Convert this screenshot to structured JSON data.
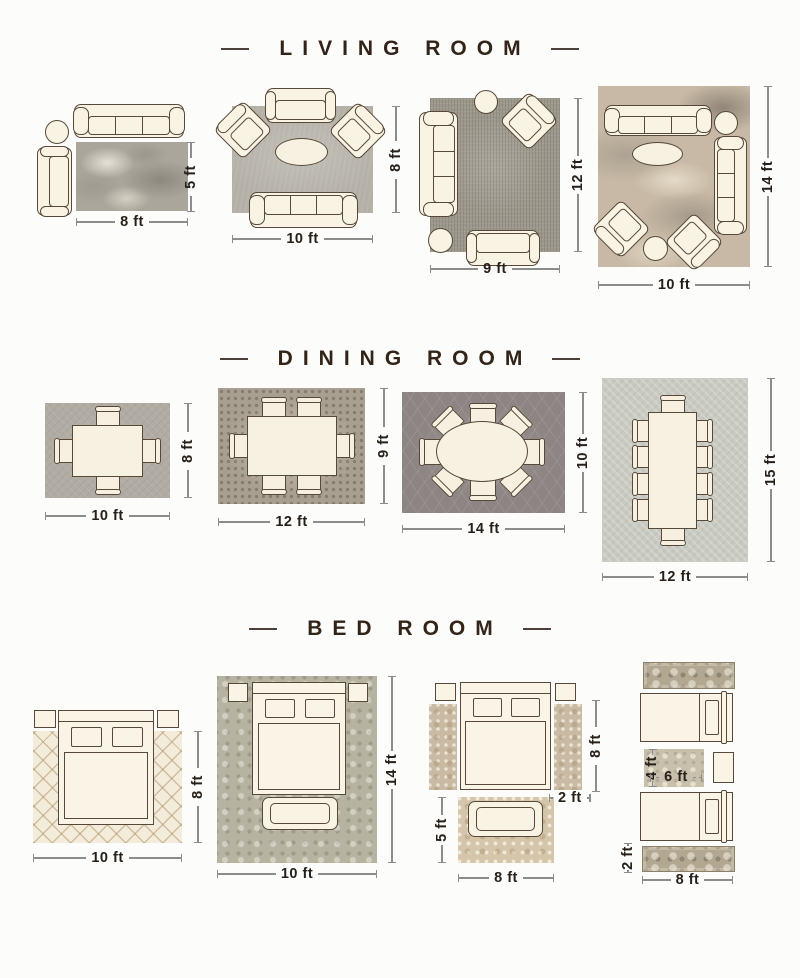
{
  "sections": [
    {
      "title": "LIVING ROOM",
      "layouts": [
        {
          "id": "living-1",
          "bottom": "8 ft",
          "side": "5 ft"
        },
        {
          "id": "living-2",
          "bottom": "10 ft",
          "side": "8 ft"
        },
        {
          "id": "living-3",
          "bottom": "9 ft",
          "side": "12 ft"
        },
        {
          "id": "living-4",
          "bottom": "10 ft",
          "side": "14 ft"
        }
      ]
    },
    {
      "title": "DINING ROOM",
      "layouts": [
        {
          "id": "dining-1",
          "bottom": "10 ft",
          "side": "8 ft"
        },
        {
          "id": "dining-2",
          "bottom": "12 ft",
          "side": "9 ft"
        },
        {
          "id": "dining-3",
          "bottom": "14 ft",
          "side": "10 ft"
        },
        {
          "id": "dining-4",
          "bottom": "12 ft",
          "side": "15 ft"
        }
      ]
    },
    {
      "title": "BED ROOM",
      "layouts": [
        {
          "id": "bed-1",
          "bottom": "10 ft",
          "side": "8 ft"
        },
        {
          "id": "bed-2",
          "bottom": "10 ft",
          "side": "14 ft"
        },
        {
          "id": "bed-3",
          "bottom": "8 ft",
          "side": "5 ft",
          "runner_height": "8 ft",
          "runner_width": "2 ft"
        },
        {
          "id": "bed-4",
          "bottom": "8 ft",
          "runner_width": "2 ft",
          "inner_width": "6 ft",
          "inner_height": "4 ft"
        }
      ]
    }
  ],
  "colors": {
    "header_text": "#33241a",
    "furniture_fill": "#f9f3e4",
    "furniture_outline": "#57493a",
    "dimension_line": "#8c8c8c"
  }
}
